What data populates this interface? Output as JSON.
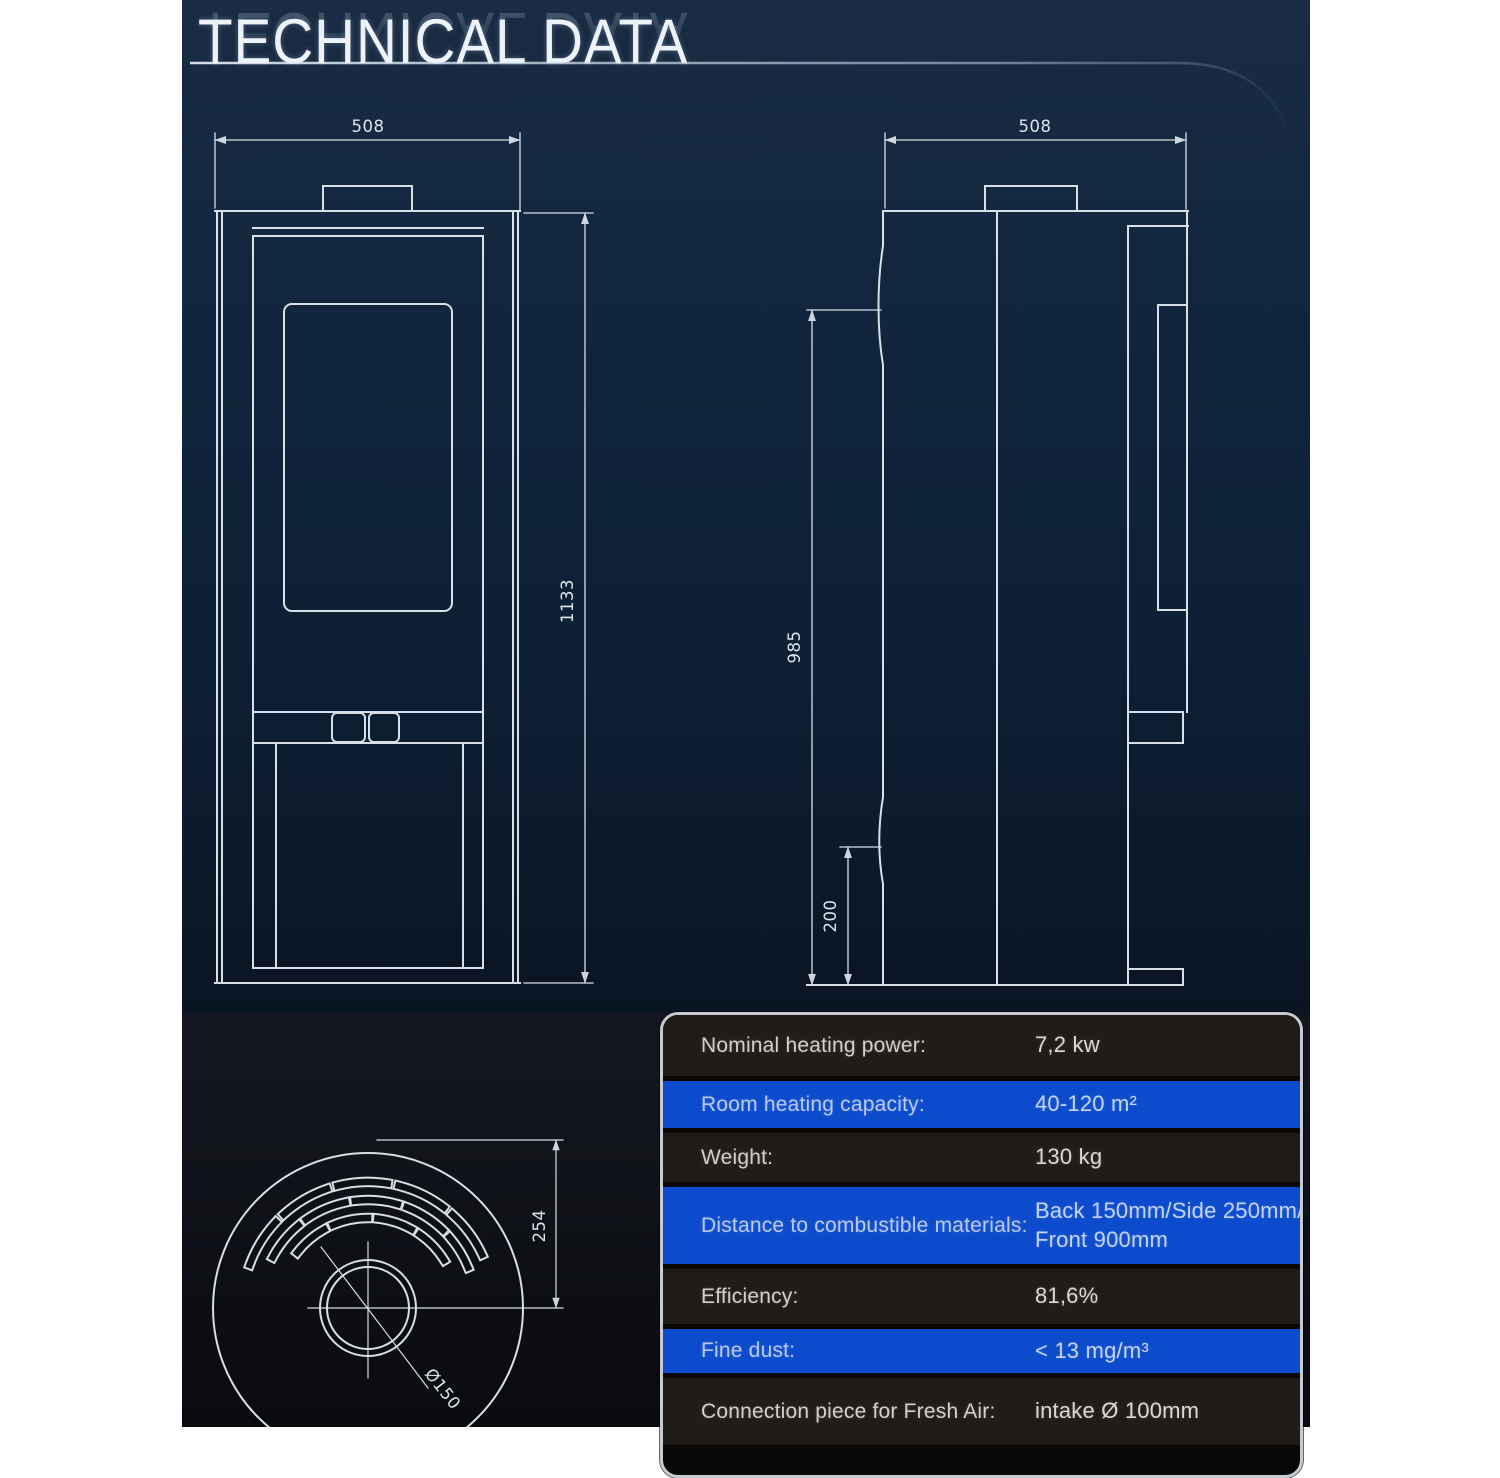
{
  "page": {
    "title": "TECHNICAL DATA"
  },
  "front_view": {
    "width_label": "508",
    "height_label": "1133"
  },
  "side_view": {
    "depth_label": "508",
    "height_label": "985",
    "outlet_label": "200"
  },
  "top_view": {
    "radius_label": "254",
    "flue_label": "Ø150"
  },
  "spec_table": {
    "rows": [
      {
        "label": "Nominal heating power:",
        "value": "7,2 kw"
      },
      {
        "label": "Room heating capacity:",
        "value": "40-120 m²"
      },
      {
        "label": "Weight:",
        "value": "130 kg"
      },
      {
        "label": "Distance to combustible materials:",
        "value": "Back 150mm/Side 250mm/",
        "value2": "Front 900mm"
      },
      {
        "label": "Efficiency:",
        "value": "81,6%"
      },
      {
        "label": "Fine dust:",
        "value": "< 13 mg/m³"
      },
      {
        "label": "Connection piece for Fresh Air:",
        "value": "intake Ø 100mm"
      }
    ]
  },
  "colors": {
    "background_navy": "#0e2135",
    "row_dark": "#1f1c19",
    "row_blue": "#0b4bcc",
    "table_border": "#c6cbd2",
    "line_white": "#e9eef4"
  }
}
